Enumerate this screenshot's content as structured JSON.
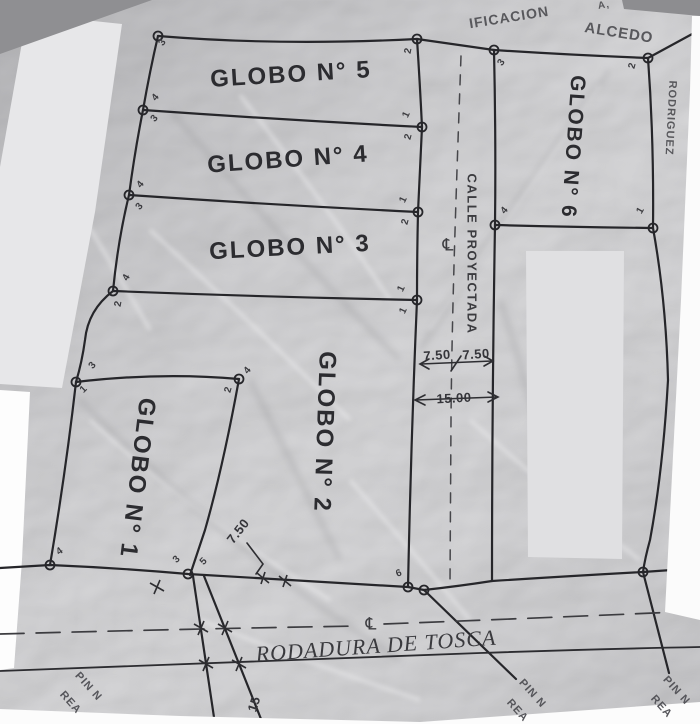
{
  "document_type": "scanned parcel survey plan",
  "colors": {
    "paper": "#c9c9cb",
    "line_ink": "#26262a",
    "redaction_gray": "#e2e2e4",
    "redaction_white": "#fdfdfd",
    "photo_edge_white": "#fcfcfc",
    "photo_background": "#8f8f92"
  },
  "street": {
    "name": "CALLE PROYECTADA",
    "centerline_symbol": "℄"
  },
  "road": {
    "name": "RODADURA DE TOSCA",
    "centerline_symbol": "℄"
  },
  "annotations": [
    {
      "id": "parcel-label-globo-5",
      "cls": "parcel",
      "text": "GLOBO N° 5",
      "x": 291,
      "y": 75,
      "r": -3.5,
      "fs": 24
    },
    {
      "id": "parcel-label-globo-4",
      "cls": "parcel",
      "text": "GLOBO N° 4",
      "x": 288,
      "y": 160,
      "r": -4,
      "fs": 24
    },
    {
      "id": "parcel-label-globo-3",
      "cls": "parcel",
      "text": "GLOBO N° 3",
      "x": 290,
      "y": 248,
      "r": -3,
      "fs": 24
    },
    {
      "id": "parcel-label-globo-2",
      "cls": "parcel",
      "text": "GLOBO N° 2",
      "x": 324,
      "y": 432,
      "r": 92,
      "fs": 24
    },
    {
      "id": "parcel-label-globo-1",
      "cls": "parcel",
      "text": "GLOBO N° 1",
      "x": 137,
      "y": 478,
      "r": 97,
      "fs": 24
    },
    {
      "id": "parcel-label-globo-6",
      "cls": "parcel",
      "text": "GLOBO N° 6",
      "x": 573,
      "y": 147,
      "r": 94,
      "fs": 21
    },
    {
      "id": "street-name-calle-proyectada",
      "cls": "street-name",
      "text": "CALLE PROYECTADA",
      "x": 472,
      "y": 254,
      "r": 90,
      "fs": 13
    },
    {
      "id": "street-centerline-symbol",
      "cls": "cl",
      "text": "℄",
      "x": 448,
      "y": 246,
      "r": 0,
      "fs": 17
    },
    {
      "id": "road-centerline-symbol",
      "cls": "cl",
      "text": "℄",
      "x": 371,
      "y": 625,
      "r": 0,
      "fs": 17
    },
    {
      "id": "road-name-rodadura-de-tosca",
      "cls": "road-name",
      "text": "RODADURA DE TOSCA",
      "x": 376,
      "y": 646,
      "r": -4,
      "fs": 22
    },
    {
      "id": "edge-text-ificacion",
      "cls": "edge-text",
      "text": "IFICACION",
      "x": 509,
      "y": 17,
      "r": -9,
      "fs": 14
    },
    {
      "id": "edge-text-alcedo",
      "cls": "edge-text",
      "text": "ALCEDO",
      "x": 619,
      "y": 33,
      "r": 9,
      "fs": 15
    },
    {
      "id": "edge-text-fragment",
      "cls": "edge-text",
      "text": "A,",
      "x": 604,
      "y": 6,
      "r": -9,
      "fs": 10
    },
    {
      "id": "edge-text-rodriguez",
      "cls": "edge-text",
      "text": "RODRIGUEZ",
      "x": 670,
      "y": 118,
      "r": 93,
      "fs": 11
    },
    {
      "id": "dim-street-half-left",
      "cls": "dim",
      "text": "7.50",
      "x": 437,
      "y": 355,
      "r": -4,
      "fs": 13
    },
    {
      "id": "dim-street-half-right",
      "cls": "dim",
      "text": "7.50",
      "x": 476,
      "y": 354,
      "r": -4,
      "fs": 13
    },
    {
      "id": "dim-street-total",
      "cls": "dim",
      "text": "15.00",
      "x": 454,
      "y": 398,
      "r": -3,
      "fs": 13
    },
    {
      "id": "dim-globo1-side",
      "cls": "dim",
      "text": "7.50",
      "x": 238,
      "y": 531,
      "r": -52,
      "fs": 13
    },
    {
      "id": "dim-road-diagonal",
      "cls": "dim",
      "text": "15",
      "x": 254,
      "y": 704,
      "r": -72,
      "fs": 13
    },
    {
      "id": "corner-text-pin-left",
      "cls": "corner",
      "text": "PIN N",
      "x": 88,
      "y": 687,
      "r": 48,
      "fs": 11
    },
    {
      "id": "corner-text-rea-left",
      "cls": "corner",
      "text": "REA",
      "x": 70,
      "y": 703,
      "r": 48,
      "fs": 11
    },
    {
      "id": "corner-text-pin-mid",
      "cls": "corner",
      "text": "PIN N",
      "x": 532,
      "y": 694,
      "r": 48,
      "fs": 11
    },
    {
      "id": "corner-text-rea-mid",
      "cls": "corner",
      "text": "REA",
      "x": 517,
      "y": 711,
      "r": 48,
      "fs": 11
    },
    {
      "id": "corner-text-pin-right",
      "cls": "corner",
      "text": "PIN N",
      "x": 676,
      "y": 691,
      "r": 48,
      "fs": 11
    },
    {
      "id": "corner-text-rea-right",
      "cls": "corner",
      "text": "REA",
      "x": 661,
      "y": 707,
      "r": 48,
      "fs": 11
    },
    {
      "id": "vertex-p0",
      "cls": "vertex",
      "text": "3",
      "x": 163,
      "y": 43,
      "r": -55,
      "fs": 10
    },
    {
      "id": "vertex-p1a",
      "cls": "vertex",
      "text": "4",
      "x": 156,
      "y": 98,
      "r": -50,
      "fs": 10
    },
    {
      "id": "vertex-p1b",
      "cls": "vertex",
      "text": "3",
      "x": 155,
      "y": 119,
      "r": -50,
      "fs": 10
    },
    {
      "id": "vertex-p2a",
      "cls": "vertex",
      "text": "4",
      "x": 141,
      "y": 185,
      "r": -50,
      "fs": 10
    },
    {
      "id": "vertex-p2b",
      "cls": "vertex",
      "text": "3",
      "x": 140,
      "y": 207,
      "r": -50,
      "fs": 10
    },
    {
      "id": "vertex-p3a",
      "cls": "vertex",
      "text": "4",
      "x": 127,
      "y": 278,
      "r": -60,
      "fs": 10
    },
    {
      "id": "vertex-p3b",
      "cls": "vertex",
      "text": "2",
      "x": 119,
      "y": 304,
      "r": -80,
      "fs": 10
    },
    {
      "id": "vertex-p4a",
      "cls": "vertex",
      "text": "3",
      "x": 93,
      "y": 366,
      "r": -50,
      "fs": 10
    },
    {
      "id": "vertex-p4b",
      "cls": "vertex",
      "text": "1",
      "x": 84,
      "y": 390,
      "r": -45,
      "fs": 10
    },
    {
      "id": "vertex-p5",
      "cls": "vertex",
      "text": "4",
      "x": 60,
      "y": 552,
      "r": -35,
      "fs": 10
    },
    {
      "id": "vertex-b1",
      "cls": "vertex",
      "text": "3",
      "x": 177,
      "y": 560,
      "r": -45,
      "fs": 10
    },
    {
      "id": "vertex-b2",
      "cls": "vertex",
      "text": "5",
      "x": 204,
      "y": 562,
      "r": -45,
      "fs": 10
    },
    {
      "id": "vertex-b6",
      "cls": "vertex",
      "text": "6",
      "x": 399,
      "y": 574,
      "r": -20,
      "fs": 10
    },
    {
      "id": "vertex-q0",
      "cls": "vertex",
      "text": "2",
      "x": 409,
      "y": 51,
      "r": -80,
      "fs": 10
    },
    {
      "id": "vertex-q1a",
      "cls": "vertex",
      "text": "1",
      "x": 407,
      "y": 115,
      "r": -65,
      "fs": 10
    },
    {
      "id": "vertex-q1b",
      "cls": "vertex",
      "text": "2",
      "x": 409,
      "y": 137,
      "r": -75,
      "fs": 10
    },
    {
      "id": "vertex-q2a",
      "cls": "vertex",
      "text": "1",
      "x": 404,
      "y": 200,
      "r": -65,
      "fs": 10
    },
    {
      "id": "vertex-q2b",
      "cls": "vertex",
      "text": "2",
      "x": 406,
      "y": 222,
      "r": -75,
      "fs": 10
    },
    {
      "id": "vertex-q3a",
      "cls": "vertex",
      "text": "1",
      "x": 402,
      "y": 289,
      "r": -65,
      "fs": 10
    },
    {
      "id": "vertex-q3b",
      "cls": "vertex",
      "text": "1",
      "x": 404,
      "y": 311,
      "r": -65,
      "fs": 10
    },
    {
      "id": "vertex-r0",
      "cls": "vertex",
      "text": "3",
      "x": 502,
      "y": 63,
      "r": -55,
      "fs": 10
    },
    {
      "id": "vertex-r1",
      "cls": "vertex",
      "text": "4",
      "x": 505,
      "y": 211,
      "r": -50,
      "fs": 10
    },
    {
      "id": "vertex-tr",
      "cls": "vertex",
      "text": "2",
      "x": 633,
      "y": 66,
      "r": -75,
      "fs": 10
    },
    {
      "id": "vertex-g6",
      "cls": "vertex",
      "text": "1",
      "x": 641,
      "y": 211,
      "r": -60,
      "fs": 10
    },
    {
      "id": "vertex-g1a",
      "cls": "vertex",
      "text": "4",
      "x": 248,
      "y": 371,
      "r": -50,
      "fs": 10
    },
    {
      "id": "vertex-g1b",
      "cls": "vertex",
      "text": "2",
      "x": 229,
      "y": 390,
      "r": -75,
      "fs": 10
    }
  ]
}
